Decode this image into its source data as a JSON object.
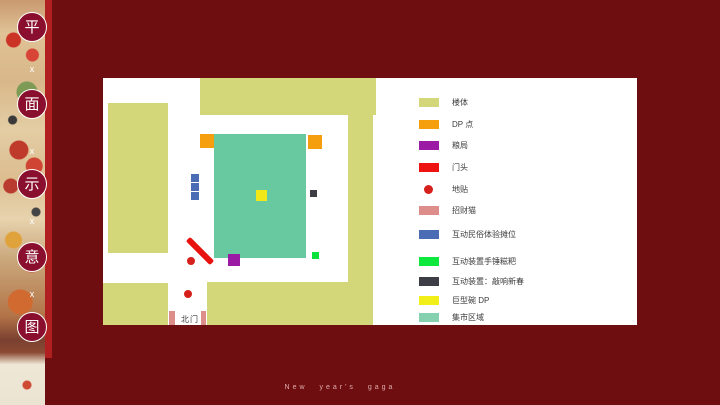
{
  "slide": {
    "background": "#6e0e10",
    "accent_bar": "#b02020",
    "caption": "New year's gaga"
  },
  "title_column": {
    "characters": [
      "平",
      "面",
      "示",
      "意",
      "图"
    ],
    "separator": "x",
    "circle_color": "#8a0f2e"
  },
  "map": {
    "north_gate_label": "北门",
    "colors": {
      "building": "#d3d77a",
      "market": "#68c9a0",
      "dp_point": "#f59e0e",
      "grain_bureau": "#9c1ba5",
      "gate_head": "#e8130f",
      "floor_sticker": "#d6201c",
      "lucky_cat": "#dd8e8a",
      "stall": "#4a6cb4",
      "green_device": "#0ce23c",
      "dark_device": "#3d3d45",
      "giant_bowl": "#f2e818"
    }
  },
  "legend": {
    "items": [
      {
        "label": "楼体",
        "color": "#d3d77a",
        "shape": "square"
      },
      {
        "label": "DP 点",
        "color": "#f59e0e",
        "shape": "square"
      },
      {
        "label": "粮局",
        "color": "#9c1ba5",
        "shape": "square"
      },
      {
        "label": "门头",
        "color": "#ee1310",
        "shape": "square"
      },
      {
        "label": "地贴",
        "color": "#d6201c",
        "shape": "dot"
      },
      {
        "label": "招财猫",
        "color": "#dd8e8a",
        "shape": "square"
      },
      {
        "label": "互动民俗体验摊位",
        "color": "#4a6cb4",
        "shape": "square"
      },
      {
        "label": "互动装置手锤糍粑",
        "color": "#0ce83c",
        "shape": "square"
      },
      {
        "label": "互动装置：敲响新春",
        "color": "#3d3d45",
        "shape": "square"
      },
      {
        "label": "巨型碗 DP",
        "color": "#f2ee18",
        "shape": "square"
      },
      {
        "label": "集市区域",
        "color": "#85d0ae",
        "shape": "square"
      }
    ]
  }
}
